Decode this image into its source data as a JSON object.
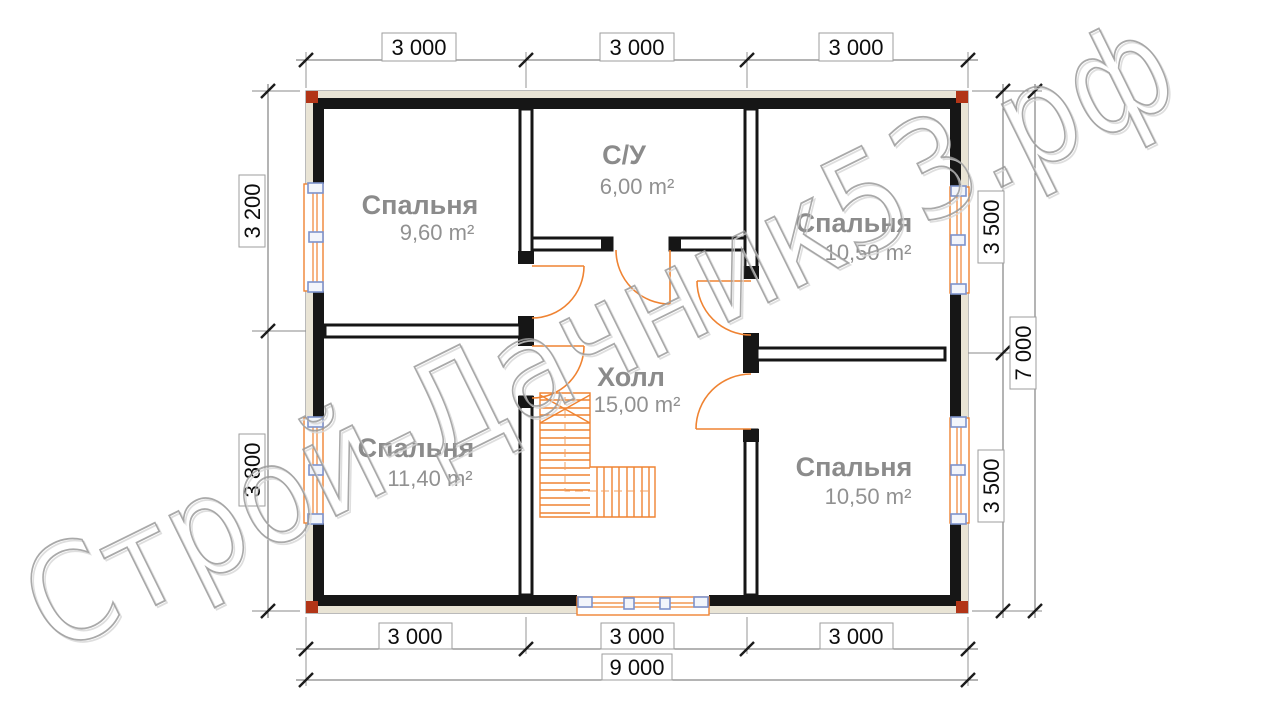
{
  "watermark": {
    "text": "Строй-Дачник53.рф"
  },
  "rooms": {
    "bedroom_tl": {
      "name": "Спальня",
      "area": "9,60 m²"
    },
    "bathroom": {
      "name": "С/У",
      "area": "6,00 m²"
    },
    "bedroom_tr": {
      "name": "Спальня",
      "area": "10,50 m²"
    },
    "hall": {
      "name": "Холл",
      "area": "15,00 m²"
    },
    "bedroom_bl": {
      "name": "Спальня",
      "area": "11,40 m²"
    },
    "bedroom_br": {
      "name": "Спальня",
      "area": "10,50 m²"
    }
  },
  "dimensions": {
    "top": [
      "3 000",
      "3 000",
      "3 000"
    ],
    "bottom": [
      "3 000",
      "3 000",
      "3 000"
    ],
    "bottom_total": "9 000",
    "left": [
      "3 200",
      "3 800"
    ],
    "right": [
      "3 500",
      "3 500"
    ],
    "right_total": "7 000"
  },
  "colors": {
    "wall_black": "#161616",
    "wall_cream": "#e9e4d5",
    "accent_orange": "#ef8332",
    "accent_blue": "#7d93cc",
    "corner_red": "#b23517",
    "label_gray": "#8b8b8b",
    "watermark_gray": "#9b9b9b"
  }
}
